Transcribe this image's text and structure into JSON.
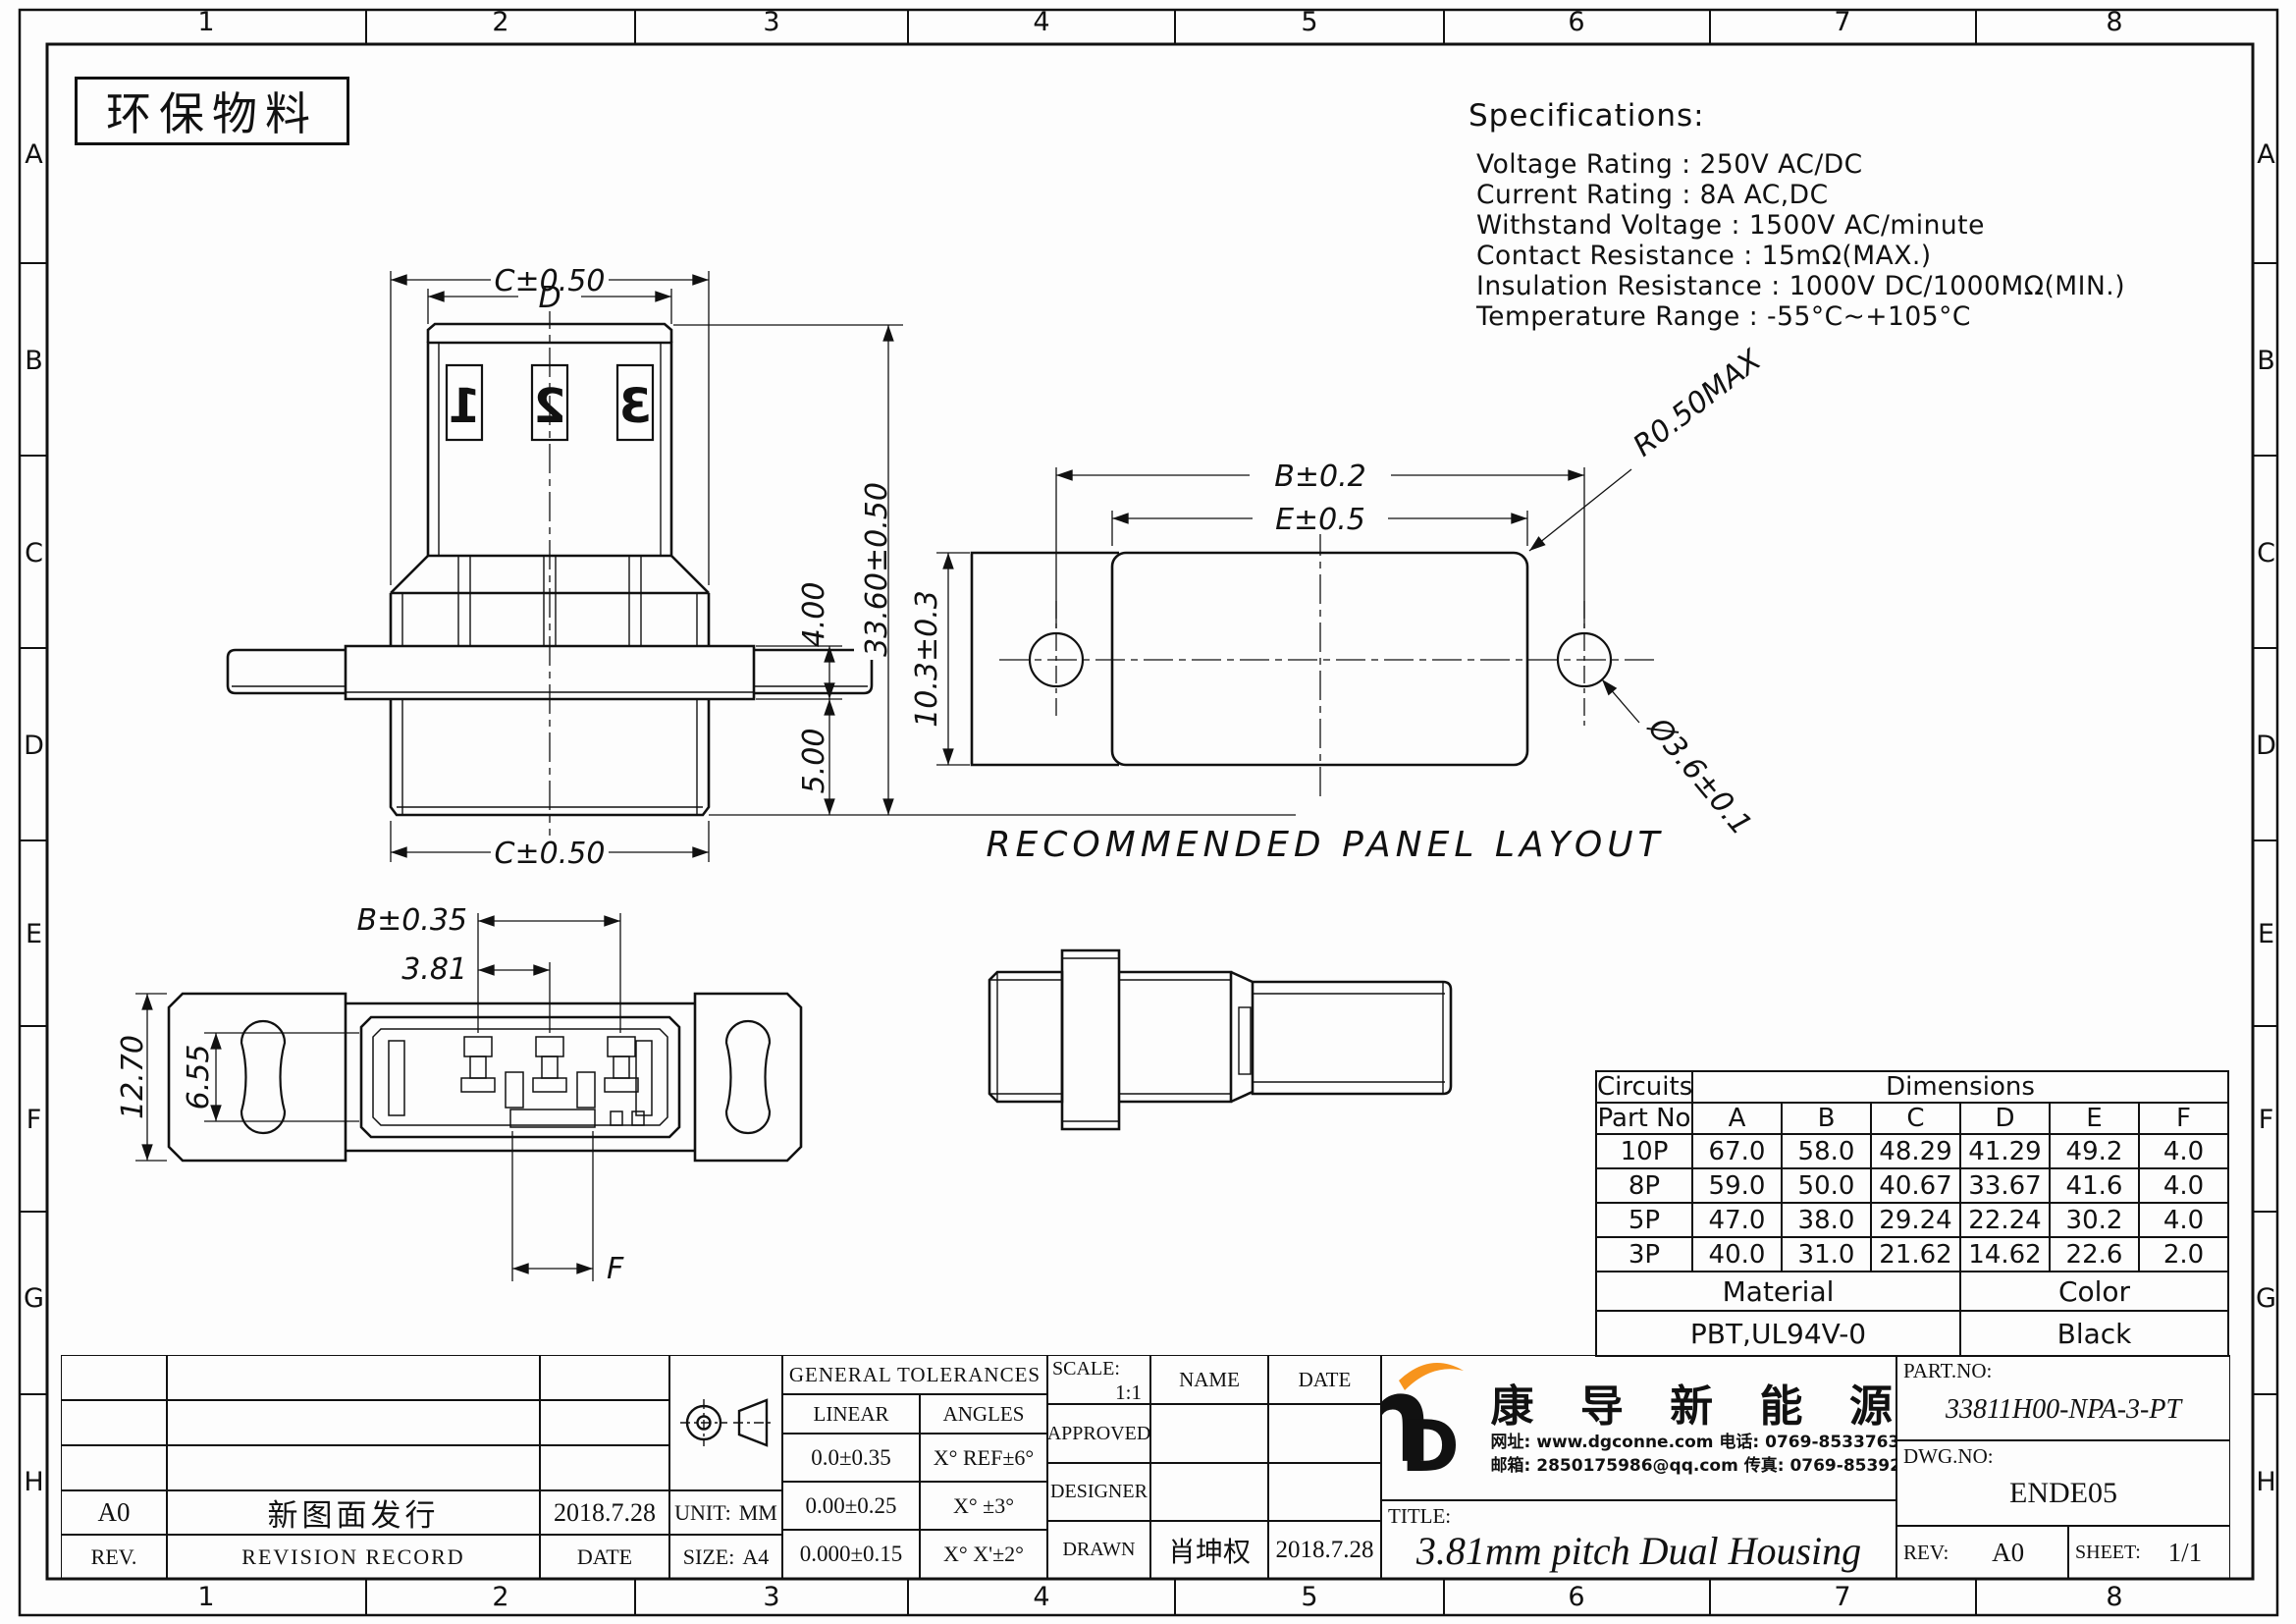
{
  "frame": {
    "cols": [
      "1",
      "2",
      "3",
      "4",
      "5",
      "6",
      "7",
      "8"
    ],
    "rows": [
      "A",
      "B",
      "C",
      "D",
      "E",
      "F",
      "G",
      "H"
    ]
  },
  "stamp": {
    "text": "环保物料"
  },
  "specs": {
    "title": "Specifications:",
    "lines": [
      "Voltage Rating : 250V AC/DC",
      "Current Rating : 8A AC,DC",
      "Withstand Voltage : 1500V AC/minute",
      "Contact Resistance : 15mΩ(MAX.)",
      "Insulation Resistance : 1000V DC/1000MΩ(MIN.)",
      "Temperature Range : -55°C~+105°C"
    ]
  },
  "front_view": {
    "pins": [
      "1",
      "2",
      "3"
    ],
    "dim_c_top": "C±0.50",
    "dim_d": "D",
    "dim_height": "33.60±0.50",
    "dim_4": "4.00",
    "dim_5": "5.00",
    "dim_c_bottom": "C±0.50"
  },
  "panel_view": {
    "title": "RECOMMENDED PANEL LAYOUT",
    "dim_b": "B±0.2",
    "dim_e": "E±0.5",
    "dim_h": "10.3±0.3",
    "dim_r": "R0.50MAX",
    "dim_hole": "Ø3.6±0.1"
  },
  "plan_view": {
    "dim_b": "B±0.35",
    "dim_pitch": "3.81",
    "dim_12": "12.70",
    "dim_6": "6.55",
    "dim_f": "F"
  },
  "dims_table": {
    "circuits_label": "Circuits",
    "part_no_label": "Part No",
    "dimensions_label": "Dimensions",
    "columns": [
      "A",
      "B",
      "C",
      "D",
      "E",
      "F"
    ],
    "rows": [
      {
        "part": "10P",
        "values": [
          "67.0",
          "58.0",
          "48.29",
          "41.29",
          "49.2",
          "4.0"
        ]
      },
      {
        "part": "8P",
        "values": [
          "59.0",
          "50.0",
          "40.67",
          "33.67",
          "41.6",
          "4.0"
        ]
      },
      {
        "part": "5P",
        "values": [
          "47.0",
          "38.0",
          "29.24",
          "22.24",
          "30.2",
          "4.0"
        ]
      },
      {
        "part": "3P",
        "values": [
          "40.0",
          "31.0",
          "21.62",
          "14.62",
          "22.6",
          "2.0"
        ]
      }
    ],
    "material_label": "Material",
    "material_value": "PBT,UL94V-0",
    "color_label": "Color",
    "color_value": "Black"
  },
  "title_block": {
    "revision": {
      "rev_header": "REV.",
      "record_header": "REVISION RECORD",
      "date_header": "DATE",
      "entry_rev": "A0",
      "entry_desc": "新图面发行",
      "entry_date": "2018.7.28"
    },
    "unit_label": "UNIT:",
    "unit_value": "MM",
    "size_label": "SIZE:",
    "size_value": "A4",
    "tolerances": {
      "header": "GENERAL TOLERANCES",
      "linear_header": "LINEAR",
      "angles_header": "ANGLES",
      "rows": [
        [
          "0.0±0.35",
          "X° REF±6°"
        ],
        [
          "0.00±0.25",
          "X° ±3°"
        ],
        [
          "0.000±0.15",
          "X° X'±2°"
        ]
      ]
    },
    "approval": {
      "scale_label": "SCALE:",
      "scale_value": "1:1",
      "name_header": "NAME",
      "date_header": "DATE",
      "approved_label": "APPROVED",
      "designer_label": "DESIGNER",
      "drawn_label": "DRAWN",
      "drawn_name": "肖坤权",
      "drawn_date": "2018.7.28"
    },
    "company": {
      "logo_text_h": "h",
      "logo_text_d": "D",
      "name": "康 导 新 能 源",
      "line1": "网址: www.dgconne.com  电话: 0769-85337633",
      "line2": "邮箱: 2850175986@qq.com 传真: 0769-85392827",
      "brand_blue": "#29a8e0",
      "brand_orange": "#f7941d"
    },
    "title_label": "TITLE:",
    "title_value": "3.81mm pitch Dual Housing",
    "part_no_label": "PART.NO:",
    "part_no_value": "33811H00-NPA-3-PT",
    "dwg_no_label": "DWG.NO:",
    "dwg_no_value": "ENDE05",
    "rev_label": "REV:",
    "rev_value": "A0",
    "sheet_label": "SHEET:",
    "sheet_value": "1/1"
  }
}
